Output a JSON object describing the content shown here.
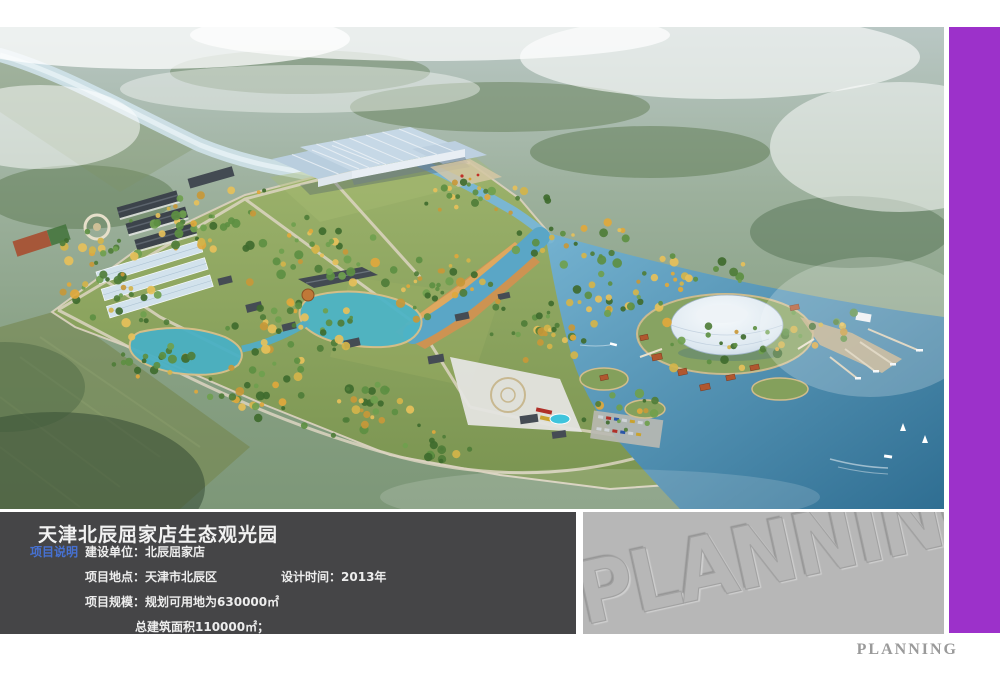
{
  "info": {
    "title": "天津北辰屈家店生态观光园",
    "tag": "项目说明",
    "client_label": "建设单位：",
    "client": "北辰屈家店",
    "location_label": "项目地点：",
    "location": "天津市北辰区",
    "design_label": "设计时间：",
    "design_time": "2013年",
    "scale_label": "项目规模：",
    "scale_line1": "规划可用地为630000㎡",
    "scale_line2": "总建筑面积110000㎡；"
  },
  "watermark": {
    "text": "PLANNING"
  },
  "footer": {
    "text": "PLANNING"
  },
  "colors": {
    "accent_purple": "#9c31ca",
    "info_panel_bg": "#454547",
    "watermark_panel_bg": "#b7b7b7",
    "section_label_blue": "#4671d2",
    "panel_text": "#ededed",
    "title_text": "#f2f2f2",
    "footer_text_gray": "#9a9a9a"
  },
  "scene": {
    "haze_top": "#b9c7c4",
    "grass": "#87a05c",
    "water_lake": "#4c92b4",
    "water_pond": "#4db4c6",
    "beach": "#cd9352",
    "dome": "#e9eff5",
    "glass_roof": "#c6d8e6",
    "dark_roof": "#454c54",
    "orange_roof": "#b0572f",
    "road": "#ddd5c2",
    "tree_greens": [
      "#3f6b2e",
      "#4f7d38",
      "#5d8f42",
      "#6fa04e"
    ],
    "tree_yellows": [
      "#d4b44a",
      "#e0a83c",
      "#c89838",
      "#e6c05a"
    ]
  }
}
